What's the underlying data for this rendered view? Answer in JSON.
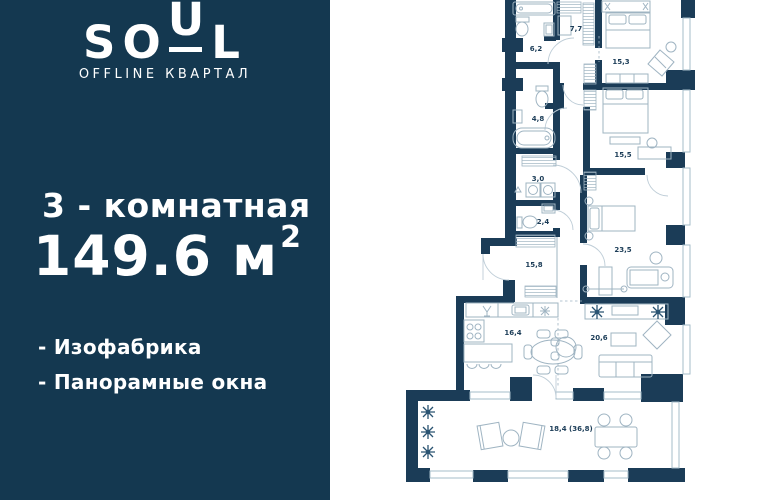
{
  "brand": {
    "logo_so": "SO",
    "logo_u": "U",
    "logo_l": "L",
    "subtitle": "OFFLINE КВАРТАЛ"
  },
  "listing": {
    "rooms_title": "3 - комнатная",
    "area_value": "149.6",
    "area_unit": " м",
    "area_sup": "2",
    "features": [
      "- Изофабрика",
      "- Панорамные окна"
    ]
  },
  "floorplan": {
    "rooms": [
      {
        "name": "wardrobe",
        "area": "7,7",
        "x": 576,
        "y": 31
      },
      {
        "name": "bathroom",
        "area": "6,2",
        "x": 536,
        "y": 51
      },
      {
        "name": "bedroom-1",
        "area": "15,3",
        "x": 621,
        "y": 64
      },
      {
        "name": "bathroom-2",
        "area": "4,8",
        "x": 538,
        "y": 121
      },
      {
        "name": "bedroom-2",
        "area": "15,5",
        "x": 623,
        "y": 157
      },
      {
        "name": "laundry",
        "area": "3,0",
        "x": 538,
        "y": 181
      },
      {
        "name": "wc",
        "area": "2,4",
        "x": 543,
        "y": 224
      },
      {
        "name": "master-bedroom",
        "area": "23,5",
        "x": 623,
        "y": 252
      },
      {
        "name": "hallway",
        "area": "15,8",
        "x": 534,
        "y": 267
      },
      {
        "name": "kitchen",
        "area": "16,4",
        "x": 513,
        "y": 335
      },
      {
        "name": "living-room",
        "area": "20,6",
        "x": 599,
        "y": 340
      },
      {
        "name": "terrace",
        "area": "18,4 (36,8)",
        "x": 571,
        "y": 431
      }
    ]
  },
  "colors": {
    "panel_bg": "#143850",
    "wall": "#1b3c57",
    "furniture_line": "#9fb4c2",
    "window_line": "#a6bcca",
    "text": "#ffffff"
  }
}
